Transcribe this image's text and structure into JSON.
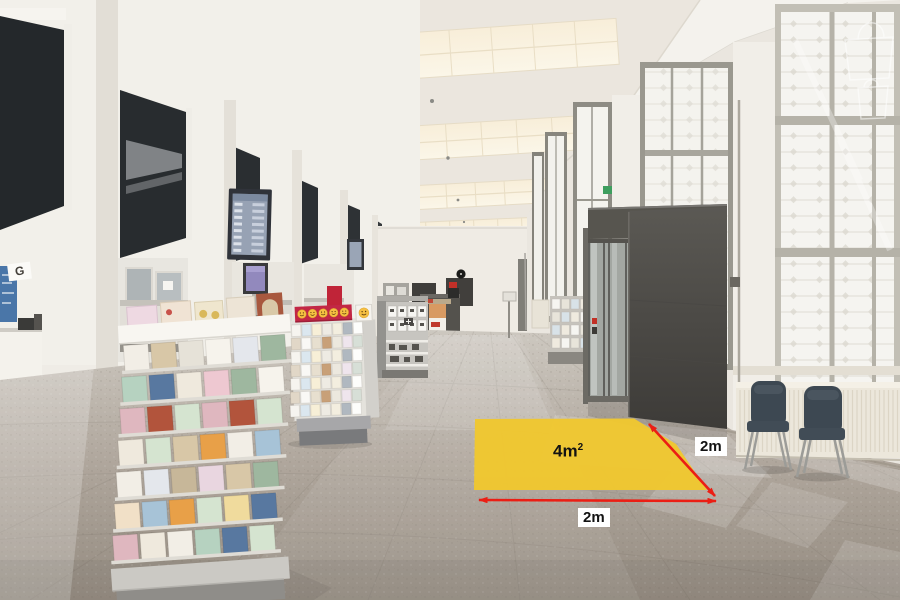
{
  "overlay": {
    "area_value": "4m",
    "area_exponent": "2",
    "side_length": "2m",
    "bottom_length": "2m",
    "highlight_color": "#EFC730",
    "arrow_color": "#EB1E14",
    "label_text_color": "#121212",
    "label_background": "#FFFFFF"
  },
  "signs": {
    "counter_letter": "G"
  },
  "icons": {
    "queue_display_screen": "blue screen with ticket rows",
    "info_screen": "small purple display",
    "departure_screen": "small blue display",
    "wall_clock": "black round clock",
    "smiley_row": "five yellow smiley faces on red banner",
    "smiley_tile": "yellow smiley face card",
    "exit_sign": "green emergency-exit sign",
    "watermark": "white shopping-bag outline"
  }
}
